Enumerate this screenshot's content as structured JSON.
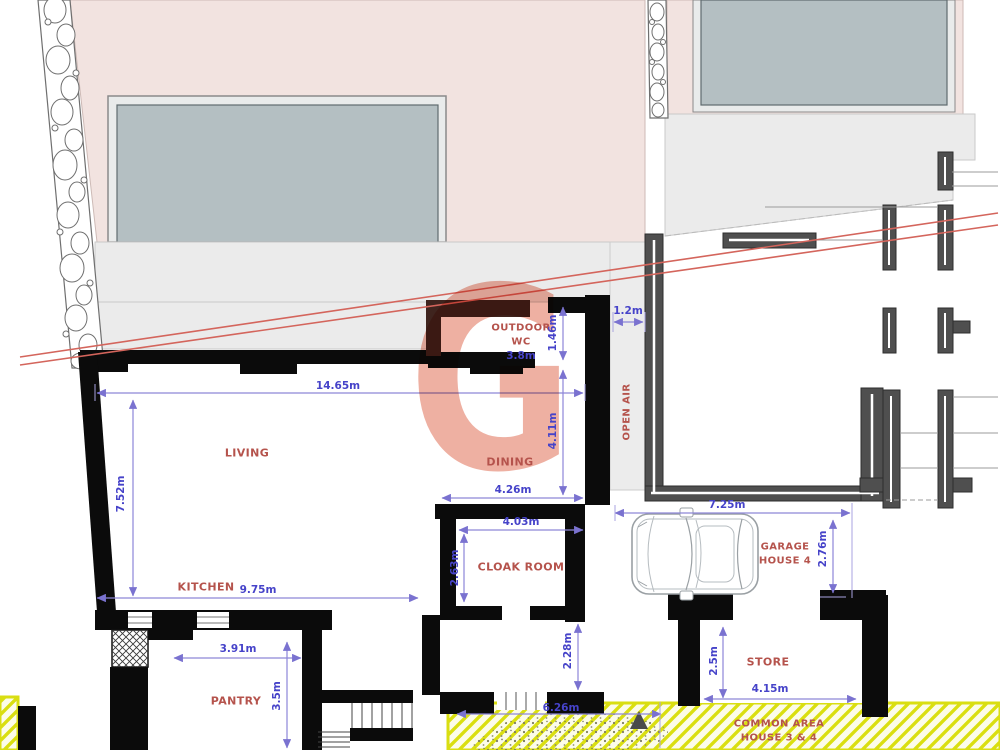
{
  "meta": {
    "type": "architectural-floor-plan",
    "watermark_letter": "G"
  },
  "rooms": {
    "living": "LIVING",
    "dining": "DINING",
    "kitchen": "KITCHEN",
    "pantry": "PANTRY",
    "cloak_room": "CLOAK ROOM",
    "outdoor_wc_line1": "OUTDOOR",
    "outdoor_wc_line2": "WC",
    "open_air": "OPEN AIR",
    "garage_line1": "GARAGE",
    "garage_line2": "HOUSE 4",
    "store": "STORE",
    "common_area_line1": "COMMON AREA",
    "common_area_line2": "HOUSE 3 & 4"
  },
  "dimensions": {
    "living_width": "14.65m",
    "living_height": "7.52m",
    "kitchen_width": "9.75m",
    "wc_width": "3.8m",
    "wc_height": "1.46m",
    "dining_height": "4.11m",
    "dining_width": "4.26m",
    "open_air_gap": "1.2m",
    "cloak_width": "4.03m",
    "cloak_height": "2.63m",
    "pantry_width": "3.91m",
    "pantry_height": "3.5m",
    "garage_width": "7.25m",
    "garage_depth": "2.76m",
    "store_width": "4.15m",
    "store_depth": "2.5m",
    "rear_passage": "2.28m",
    "common_area_width": "6.26m"
  },
  "colors": {
    "wall_black": "#0b0b0b",
    "wall_dark_gray": "#4f4f4f",
    "wc_wall_brown": "#3f241e",
    "building_pink": "#f2e3e0",
    "glass_gray": "#b4bfc2",
    "terrace_gray": "#ebebeb",
    "dimension_blue": "#4643c9",
    "dimension_line": "#8d86d8",
    "label_red": "#b5534c",
    "boundary_red": "#d4655c",
    "common_area_yellow": "#d9de12",
    "watermark_salmon": "#eeb0a2"
  }
}
